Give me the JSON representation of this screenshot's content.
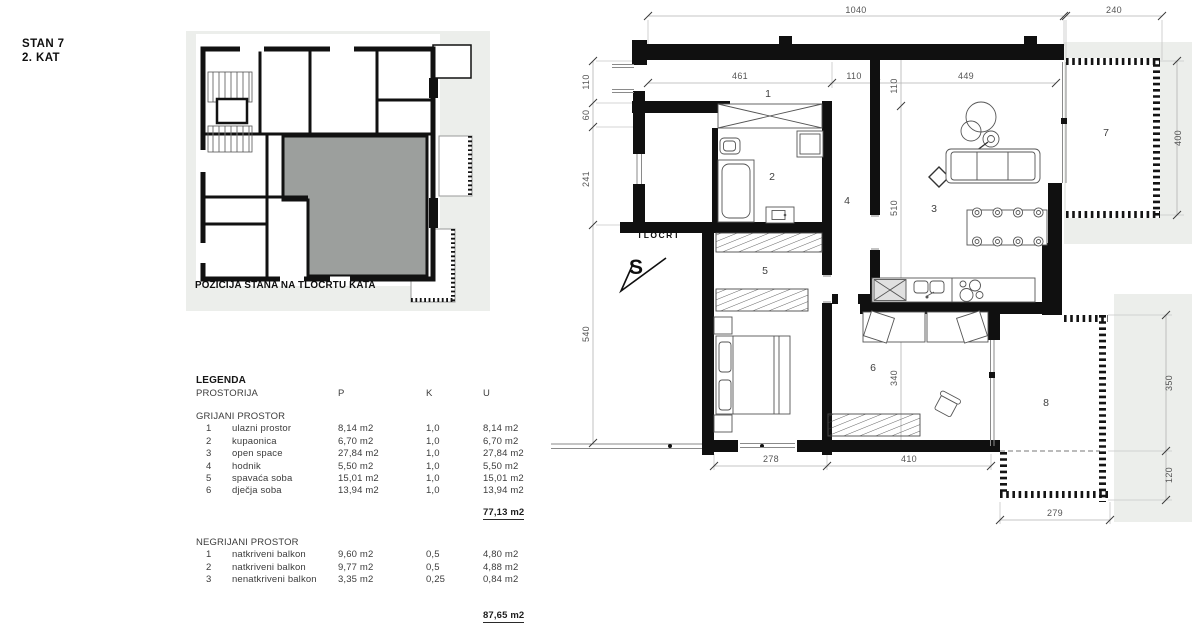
{
  "title": {
    "line1": "STAN 7",
    "line2": "2. KAT"
  },
  "position_diagram": {
    "caption": "POZICIJA STANA NA TLOCRTU KATA"
  },
  "legend": {
    "heading": "LEGENDA",
    "columns": {
      "room": "PROSTORIJA",
      "p": "P",
      "k": "K",
      "u": "U"
    },
    "heated": {
      "title": "GRIJANI PROSTOR",
      "rows": [
        {
          "n": "1",
          "name": "ulazni prostor",
          "p": "8,14 m2",
          "k": "1,0",
          "u": "8,14 m2"
        },
        {
          "n": "2",
          "name": "kupaonica",
          "p": "6,70 m2",
          "k": "1,0",
          "u": "6,70 m2"
        },
        {
          "n": "3",
          "name": "open space",
          "p": "27,84 m2",
          "k": "1,0",
          "u": "27,84 m2"
        },
        {
          "n": "4",
          "name": "hodnik",
          "p": "5,50 m2",
          "k": "1,0",
          "u": "5,50 m2"
        },
        {
          "n": "5",
          "name": "spavaća soba",
          "p": "15,01 m2",
          "k": "1,0",
          "u": "15,01 m2"
        },
        {
          "n": "6",
          "name": "dječja soba",
          "p": "13,94 m2",
          "k": "1,0",
          "u": "13,94 m2"
        }
      ],
      "total": "77,13 m2"
    },
    "unheated": {
      "title": "NEGRIJANI PROSTOR",
      "rows": [
        {
          "n": "1",
          "name": "natkriveni balkon",
          "p": "9,60 m2",
          "k": "0,5",
          "u": "4,80 m2"
        },
        {
          "n": "2",
          "name": "natkriveni balkon",
          "p": "9,77 m2",
          "k": "0,5",
          "u": "4,88 m2"
        },
        {
          "n": "3",
          "name": "nenatkriveni balkon",
          "p": "3,35 m2",
          "k": "0,25",
          "u": "0,84 m2"
        }
      ],
      "total": "87,65 m2"
    }
  },
  "plan": {
    "label": "TLOCRT",
    "north": "S",
    "rooms": {
      "r1": "1",
      "r2": "2",
      "r3": "3",
      "r4": "4",
      "r5": "5",
      "r6": "6",
      "r7": "7",
      "r8": "8"
    },
    "dims": {
      "top_main": "1040",
      "top_balcony": "240",
      "inner_left": "461",
      "inner_mid": "110",
      "inner_right": "449",
      "entry_height": "110",
      "left_1": "110",
      "left_2": "60",
      "left_3": "241",
      "left_4": "540",
      "mid_upper": "510",
      "mid_lower": "340",
      "balcony7_h": "400",
      "balcony8_h1": "350",
      "balcony8_h2": "120",
      "balcony8_w": "279",
      "bottom_left": "278",
      "bottom_right": "410"
    }
  }
}
